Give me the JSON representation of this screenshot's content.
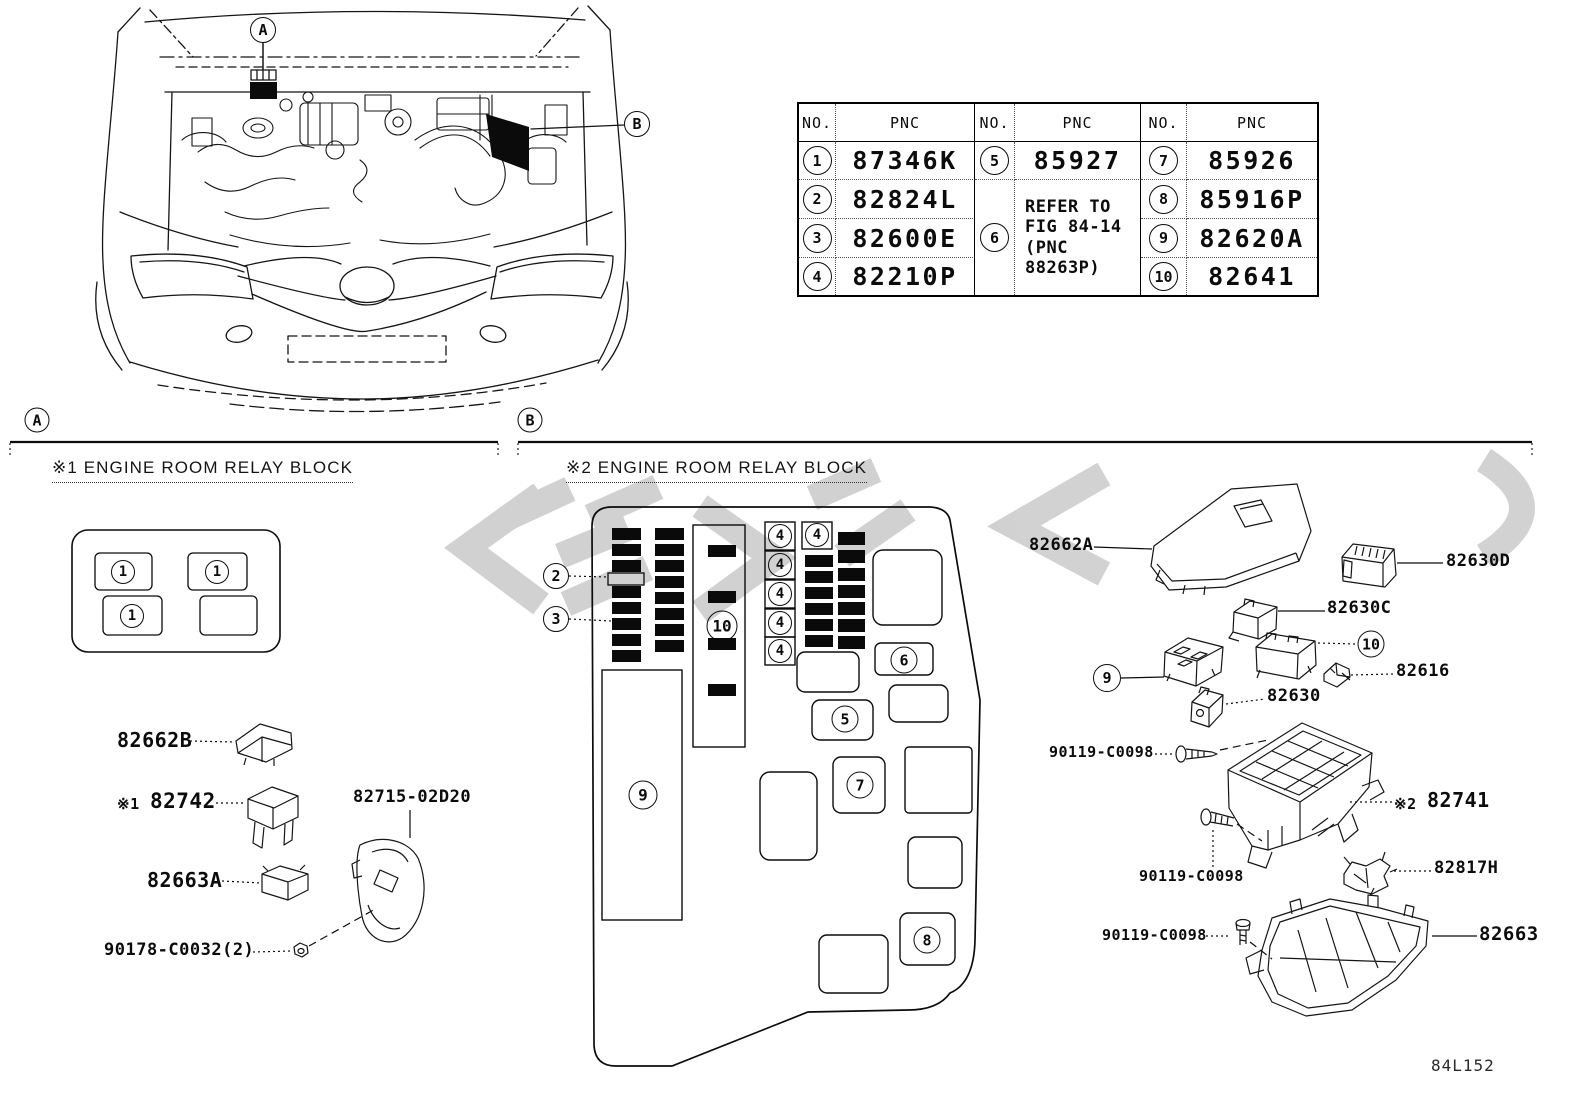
{
  "page": {
    "figure_code": "84L152"
  },
  "car": {
    "callout_a": "A",
    "callout_b": "B"
  },
  "sections": {
    "a": {
      "letter": "A",
      "title": "※1 ENGINE ROOM RELAY BLOCK"
    },
    "b": {
      "letter": "B",
      "title": "※2 ENGINE ROOM RELAY BLOCK"
    }
  },
  "table": {
    "headers": [
      "NO.",
      "PNC",
      "NO.",
      "PNC",
      "NO.",
      "PNC"
    ],
    "col1": [
      {
        "no": "1",
        "pnc": "87346K"
      },
      {
        "no": "2",
        "pnc": "82824L"
      },
      {
        "no": "3",
        "pnc": "82600E"
      },
      {
        "no": "4",
        "pnc": "82210P"
      }
    ],
    "col2_top": {
      "no": "5",
      "pnc": "85927"
    },
    "col2_merged": {
      "no": "6",
      "pnc": "REFER TO\nFIG 84-14\n(PNC 88263P)"
    },
    "col3": [
      {
        "no": "7",
        "pnc": "85926"
      },
      {
        "no": "8",
        "pnc": "85916P"
      },
      {
        "no": "9",
        "pnc": "82620A"
      },
      {
        "no": "10",
        "pnc": "82641"
      }
    ]
  },
  "relay_block_a": {
    "slots": [
      "1",
      "1",
      "1"
    ]
  },
  "fusebox": {
    "c2": "2",
    "c3": "3",
    "c5": "5",
    "c6": "6",
    "c7": "7",
    "c8": "8",
    "c9": "9",
    "c10": "10",
    "fuse4": [
      "4",
      "4",
      "4",
      "4",
      "4",
      "4"
    ]
  },
  "right_column": {
    "c9": "9",
    "c10": "10"
  },
  "labels": {
    "p82662b": "82662B",
    "p82742_prefix": "※1",
    "p82742": "82742",
    "p82715": "82715-02D20",
    "p82663a": "82663A",
    "p90178": "90178-C0032(2)",
    "p82662a": "82662A",
    "p82630d": "82630D",
    "p82630c": "82630C",
    "p82616": "82616",
    "p82630": "82630",
    "p90119_a": "90119-C0098",
    "p82741_prefix": "※2",
    "p82741": "82741",
    "p90119_b": "90119-C0098",
    "p82817h": "82817H",
    "p90119_c": "90119-C0098",
    "p82663": "82663"
  }
}
